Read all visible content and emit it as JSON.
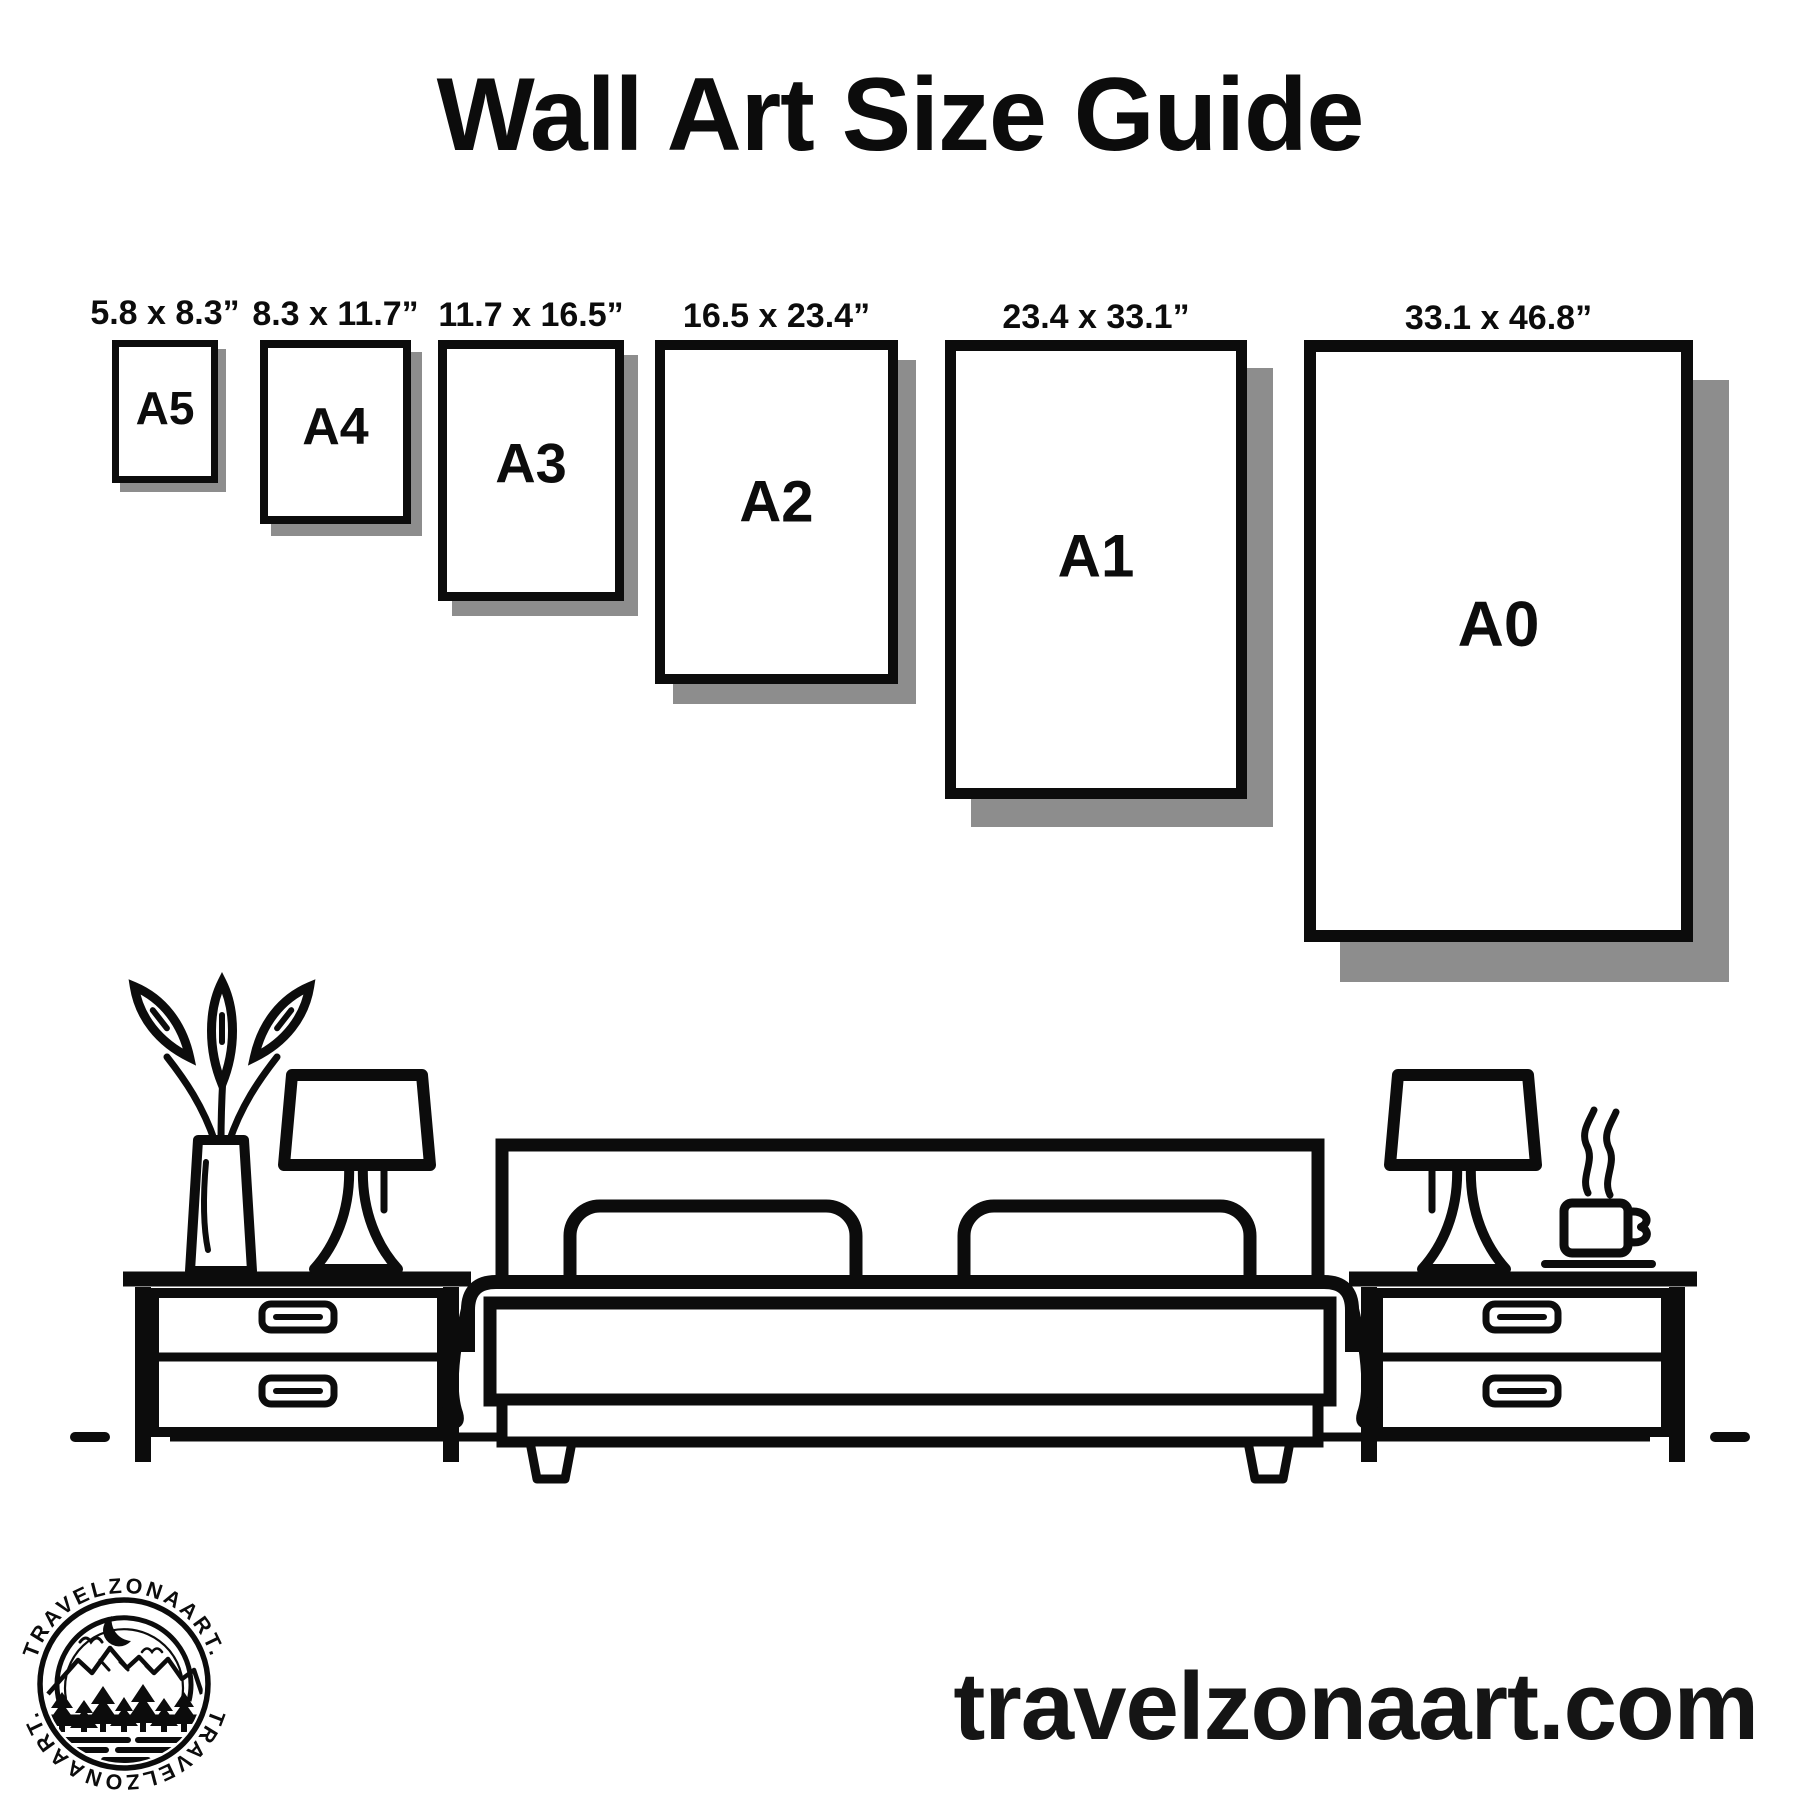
{
  "poster": {
    "title": "Wall Art Size Guide"
  },
  "frames": [
    {
      "code": "A5",
      "dimensions": "5.8 x 8.3”"
    },
    {
      "code": "A4",
      "dimensions": "8.3 x 11.7”"
    },
    {
      "code": "A3",
      "dimensions": "11.7 x 16.5”"
    },
    {
      "code": "A2",
      "dimensions": "16.5 x 23.4”"
    },
    {
      "code": "A1",
      "dimensions": "23.4 x 33.1”"
    },
    {
      "code": "A0",
      "dimensions": "33.1 x 46.8”"
    }
  ],
  "brand": {
    "website": "travelzonaart.com",
    "logo_text_top": "TRAVELZONAART.",
    "logo_text_bottom": "TRAVELZONAART."
  },
  "colors": {
    "ink": "#0c0c0c",
    "shadow_gray": "#8d8d8d",
    "background": "#ffffff"
  }
}
